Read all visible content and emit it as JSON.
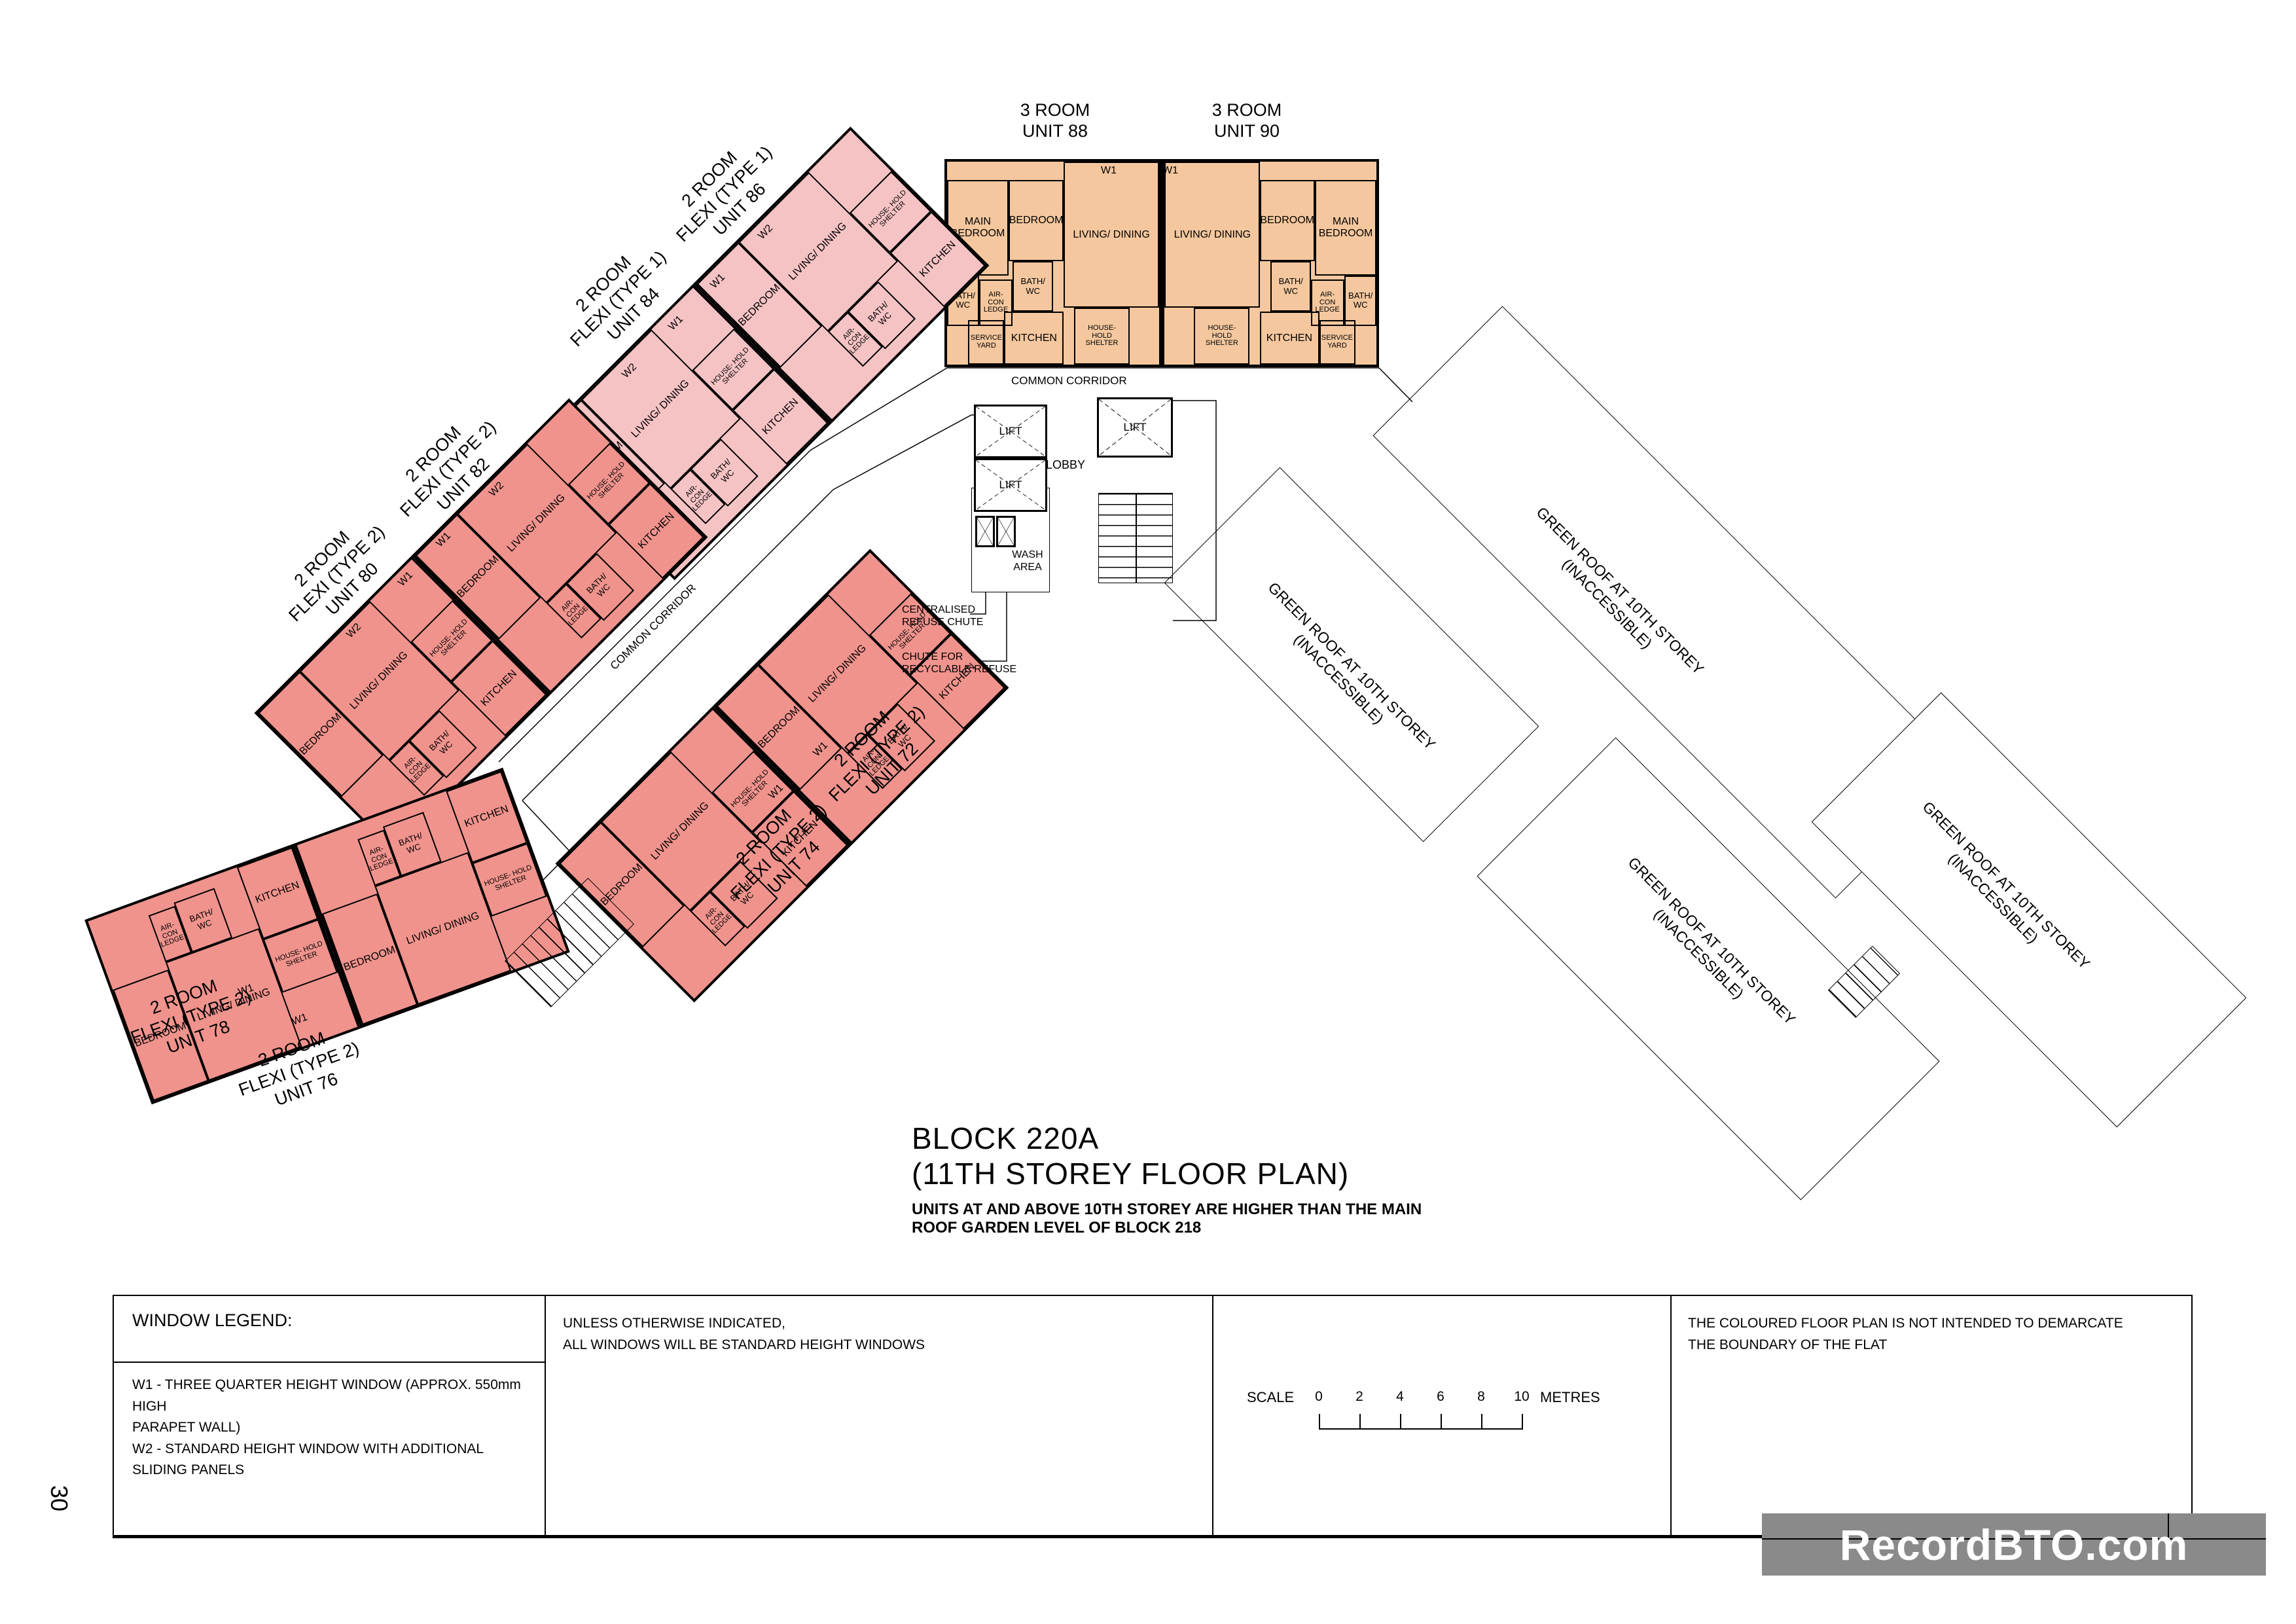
{
  "page": {
    "page_number": "30"
  },
  "title": {
    "block": "BLOCK 220A",
    "storey": "(11TH STOREY FLOOR PLAN)",
    "note_line1": "UNITS AT AND ABOVE 10TH STOREY ARE HIGHER THAN THE MAIN",
    "note_line2": "ROOF GARDEN LEVEL OF BLOCK 218"
  },
  "room_labels": {
    "main_bedroom": "MAIN BEDROOM",
    "bedroom": "BEDROOM",
    "living_dining": "LIVING/ DINING",
    "bath_wc": "BATH/ WC",
    "aircon_ledge": "AIR-CON LEDGE",
    "kitchen": "KITCHEN",
    "service_yard": "SERVICE YARD",
    "household_shelter": "HOUSE- HOLD SHELTER"
  },
  "units": {
    "u88": {
      "line1": "3 ROOM",
      "line2": "UNIT 88"
    },
    "u90": {
      "line1": "3 ROOM",
      "line2": "UNIT 90"
    },
    "u84": {
      "line1": "2 ROOM",
      "line2": "FLEXI (TYPE 1)",
      "line3": "UNIT 84"
    },
    "u86": {
      "line1": "2 ROOM",
      "line2": "FLEXI (TYPE 1)",
      "line3": "UNIT 86"
    },
    "u80": {
      "line1": "2 ROOM",
      "line2": "FLEXI (TYPE 2)",
      "line3": "UNIT 80"
    },
    "u82": {
      "line1": "2 ROOM",
      "line2": "FLEXI (TYPE 2)",
      "line3": "UNIT 82"
    },
    "u72": {
      "line1": "2 ROOM",
      "line2": "FLEXI (TYPE 2)",
      "line3": "UNIT 72"
    },
    "u74": {
      "line1": "2 ROOM",
      "line2": "FLEXI (TYPE 2)",
      "line3": "UNIT 74"
    },
    "u76": {
      "line1": "2 ROOM",
      "line2": "FLEXI (TYPE 2)",
      "line3": "UNIT 76"
    },
    "u78": {
      "line1": "2 ROOM",
      "line2": "FLEXI (TYPE 2)",
      "line3": "UNIT 78"
    }
  },
  "core": {
    "lift": "LIFT",
    "lobby": "LOBBY",
    "wash_area": "WASH AREA",
    "common_corridor": "COMMON CORRIDOR",
    "centralised_chute_line1": "CENTRALISED",
    "centralised_chute_line2": "REFUSE CHUTE",
    "recyclable_chute_line1": "CHUTE FOR",
    "recyclable_chute_line2": "RECYCLABLE REFUSE"
  },
  "green_roof": {
    "line1": "GREEN ROOF AT 10TH STOREY",
    "line2": "(INACCESSIBLE)"
  },
  "window_markers": {
    "w1": "W1",
    "w2": "W2"
  },
  "legend": {
    "window_legend_title": "WINDOW LEGEND:",
    "w1_line1": "W1 -  THREE QUARTER HEIGHT WINDOW (APPROX. 550mm HIGH",
    "w1_line2": "PARAPET WALL)",
    "w2_line": "W2 - STANDARD HEIGHT WINDOW WITH ADDITIONAL SLIDING PANELS",
    "unless_line1": "UNLESS OTHERWISE INDICATED,",
    "unless_line2": "ALL WINDOWS WILL BE STANDARD HEIGHT WINDOWS",
    "scale_label": "SCALE",
    "scale_ticks": [
      "0",
      "2",
      "4",
      "6",
      "8",
      "10"
    ],
    "scale_unit": "METRES",
    "disclaimer_line1": "THE COLOURED FLOOR PLAN IS NOT INTENDED TO DEMARCATE",
    "disclaimer_line2": "THE BOUNDARY OF THE FLAT"
  },
  "watermark": {
    "text": "RecordBTO.com"
  },
  "colors": {
    "three_room_fill": "#f4c79e",
    "two_room_type1_fill": "#f6c3c5",
    "two_room_type2_fill": "#f0938d",
    "watermark_bg": "#8a8a8a",
    "line": "#000000"
  }
}
